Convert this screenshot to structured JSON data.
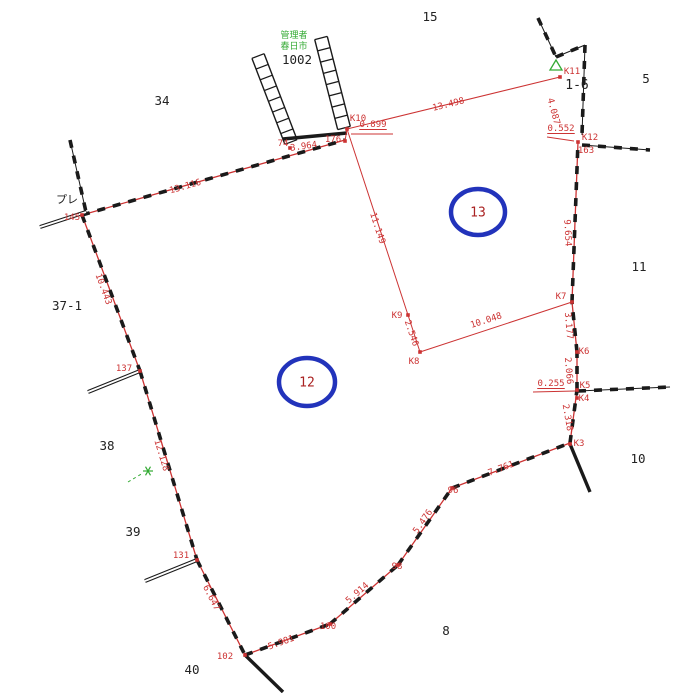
{
  "map": {
    "size": {
      "w": 673,
      "h": 693
    },
    "colors": {
      "boundary_red": "#cc3333",
      "line_black": "#1a1a1a",
      "label_black": "#222222",
      "label_red": "#cc3333",
      "circle_blue": "#2233bb",
      "circle_number_red": "#aa2222",
      "green": "#33aa33"
    },
    "black_labels": [
      {
        "text": "15",
        "x": 430,
        "y": 21,
        "size": 12.5
      },
      {
        "text": "5",
        "x": 646,
        "y": 83,
        "size": 12.5
      },
      {
        "text": "34",
        "x": 162,
        "y": 105,
        "size": 12.5
      },
      {
        "text": "1002",
        "x": 297,
        "y": 64,
        "size": 12.5
      },
      {
        "text": "1-6",
        "x": 577,
        "y": 89,
        "size": 13
      },
      {
        "text": "37-1",
        "x": 67,
        "y": 310,
        "size": 12.5
      },
      {
        "text": "11",
        "x": 639,
        "y": 271,
        "size": 12.5
      },
      {
        "text": "38",
        "x": 107,
        "y": 450,
        "size": 12.5
      },
      {
        "text": "10",
        "x": 638,
        "y": 463,
        "size": 12.5
      },
      {
        "text": "39",
        "x": 133,
        "y": 536,
        "size": 12.5
      },
      {
        "text": "8",
        "x": 446,
        "y": 635,
        "size": 12.5
      },
      {
        "text": "40",
        "x": 192,
        "y": 674,
        "size": 12.5
      },
      {
        "text": "プレ",
        "x": 67,
        "y": 203,
        "size": 11
      }
    ],
    "green_annotation": {
      "lines": [
        "管理者",
        "春日市"
      ],
      "x": 294,
      "y": 38,
      "line_h": 11,
      "size": 9
    },
    "measurements": [
      {
        "text": "13.116",
        "x": 186,
        "y": 189,
        "rot": -16
      },
      {
        "text": "10.443",
        "x": 101,
        "y": 290,
        "rot": 70
      },
      {
        "text": "12.128",
        "x": 159,
        "y": 456,
        "rot": 73
      },
      {
        "text": "6.647",
        "x": 209,
        "y": 599,
        "rot": 63
      },
      {
        "text": "5.981",
        "x": 282,
        "y": 645,
        "rot": -20
      },
      {
        "text": "5.914",
        "x": 359,
        "y": 595,
        "rot": -41
      },
      {
        "text": "5.476",
        "x": 425,
        "y": 523,
        "rot": -55
      },
      {
        "text": "7.761",
        "x": 502,
        "y": 471,
        "rot": -21
      },
      {
        "text": "2.318",
        "x": 565,
        "y": 418,
        "rot": 80
      },
      {
        "text": "2.066",
        "x": 566,
        "y": 371,
        "rot": 85
      },
      {
        "text": "3.177",
        "x": 566,
        "y": 326,
        "rot": 85
      },
      {
        "text": "9.654",
        "x": 565,
        "y": 233,
        "rot": 87
      },
      {
        "text": "4.087",
        "x": 551,
        "y": 112,
        "rot": 75
      },
      {
        "text": "13.498",
        "x": 449,
        "y": 107,
        "rot": -14
      },
      {
        "text": "11.149",
        "x": 375,
        "y": 229,
        "rot": 72
      },
      {
        "text": "2.546",
        "x": 409,
        "y": 334,
        "rot": 71
      },
      {
        "text": "10.048",
        "x": 487,
        "y": 323,
        "rot": -18
      },
      {
        "text": "3.964",
        "x": 304,
        "y": 149,
        "rot": -8
      }
    ],
    "underlined_labels": [
      {
        "text": "0.899",
        "x": 373,
        "y": 127
      },
      {
        "text": "0.552",
        "x": 561,
        "y": 131
      },
      {
        "text": "0.255",
        "x": 551,
        "y": 386
      }
    ],
    "point_labels": [
      {
        "text": "K11",
        "x": 572,
        "y": 74
      },
      {
        "text": "K12",
        "x": 590,
        "y": 140
      },
      {
        "text": "163",
        "x": 586,
        "y": 153
      },
      {
        "text": "K10",
        "x": 358,
        "y": 121
      },
      {
        "text": "176",
        "x": 333,
        "y": 142
      },
      {
        "text": "74",
        "x": 283,
        "y": 146
      },
      {
        "text": "145",
        "x": 72,
        "y": 220
      },
      {
        "text": "K9",
        "x": 397,
        "y": 318
      },
      {
        "text": "K8",
        "x": 414,
        "y": 364
      },
      {
        "text": "K7",
        "x": 561,
        "y": 299
      },
      {
        "text": "K6",
        "x": 584,
        "y": 354
      },
      {
        "text": "K5",
        "x": 585,
        "y": 388
      },
      {
        "text": "K4",
        "x": 584,
        "y": 401
      },
      {
        "text": "K3",
        "x": 579,
        "y": 446
      },
      {
        "text": "96",
        "x": 453,
        "y": 493
      },
      {
        "text": "98",
        "x": 397,
        "y": 569
      },
      {
        "text": "100",
        "x": 328,
        "y": 629
      },
      {
        "text": "102",
        "x": 225,
        "y": 659
      },
      {
        "text": "137",
        "x": 124,
        "y": 371
      },
      {
        "text": "131",
        "x": 181,
        "y": 558
      }
    ],
    "circled_parcels": [
      {
        "text": "13",
        "cx": 478,
        "cy": 212,
        "rx": 27,
        "ry": 23
      },
      {
        "text": "12",
        "cx": 307,
        "cy": 382,
        "rx": 28,
        "ry": 24
      }
    ],
    "survey_points": [
      [
        82,
        215
      ],
      [
        140,
        371
      ],
      [
        197,
        560
      ],
      [
        245,
        655
      ],
      [
        330,
        624
      ],
      [
        398,
        565
      ],
      [
        452,
        488
      ],
      [
        570,
        444
      ],
      [
        577,
        398
      ],
      [
        577,
        390
      ],
      [
        577,
        352
      ],
      [
        572,
        302
      ],
      [
        578,
        142
      ],
      [
        560,
        77
      ],
      [
        347,
        129
      ],
      [
        345,
        141
      ],
      [
        290,
        148
      ],
      [
        408,
        315
      ],
      [
        420,
        352
      ]
    ],
    "lines": {
      "boundary": [
        [
          82,
          215,
          345,
          140
        ],
        [
          82,
          215,
          140,
          371
        ],
        [
          140,
          371,
          197,
          560
        ],
        [
          197,
          560,
          245,
          655
        ],
        [
          245,
          655,
          330,
          624
        ],
        [
          330,
          624,
          398,
          565
        ],
        [
          398,
          565,
          452,
          488
        ],
        [
          452,
          488,
          570,
          443
        ],
        [
          570,
          443,
          577,
          390
        ],
        [
          577,
          390,
          577,
          352
        ],
        [
          577,
          352,
          572,
          302
        ],
        [
          572,
          302,
          578,
          142
        ]
      ],
      "black_hatch": [
        [
          538,
          18,
          556,
          57
        ],
        [
          556,
          57,
          585,
          45
        ],
        [
          585,
          45,
          582,
          135
        ],
        [
          582,
          145,
          650,
          150
        ],
        [
          578,
          391,
          670,
          387
        ],
        [
          70,
          140,
          86,
          212
        ]
      ],
      "black_double": [
        [
          86,
          212,
          40,
          227
        ],
        [
          140,
          371,
          88,
          392
        ],
        [
          197,
          560,
          145,
          581
        ]
      ],
      "black_thick": [
        [
          283,
          139,
          347,
          133
        ],
        [
          245,
          655,
          283,
          692
        ],
        [
          570,
          444,
          590,
          492
        ]
      ],
      "red": [
        [
          347,
          129,
          560,
          77
        ],
        [
          347,
          129,
          408,
          315
        ],
        [
          408,
          315,
          420,
          352
        ],
        [
          420,
          352,
          572,
          302
        ],
        [
          345,
          141,
          347,
          129
        ],
        [
          351,
          134,
          393,
          134
        ],
        [
          547,
          137,
          574,
          141
        ],
        [
          533,
          392,
          575,
          391
        ]
      ],
      "green_dashed": [
        [
          128,
          482,
          143,
          473
        ]
      ]
    },
    "ladders": [
      {
        "x1": 258,
        "y1": 56,
        "x2": 291,
        "y2": 142,
        "w": 13,
        "rungs": 8
      },
      {
        "x1": 321,
        "y1": 38,
        "x2": 344,
        "y2": 128,
        "w": 13,
        "rungs": 8
      }
    ],
    "green_markers": {
      "triangle": {
        "points": [
          [
            556,
            60
          ],
          [
            550,
            70
          ],
          [
            562,
            70
          ]
        ]
      },
      "star": {
        "x": 148,
        "y": 471,
        "r": 5
      }
    }
  }
}
